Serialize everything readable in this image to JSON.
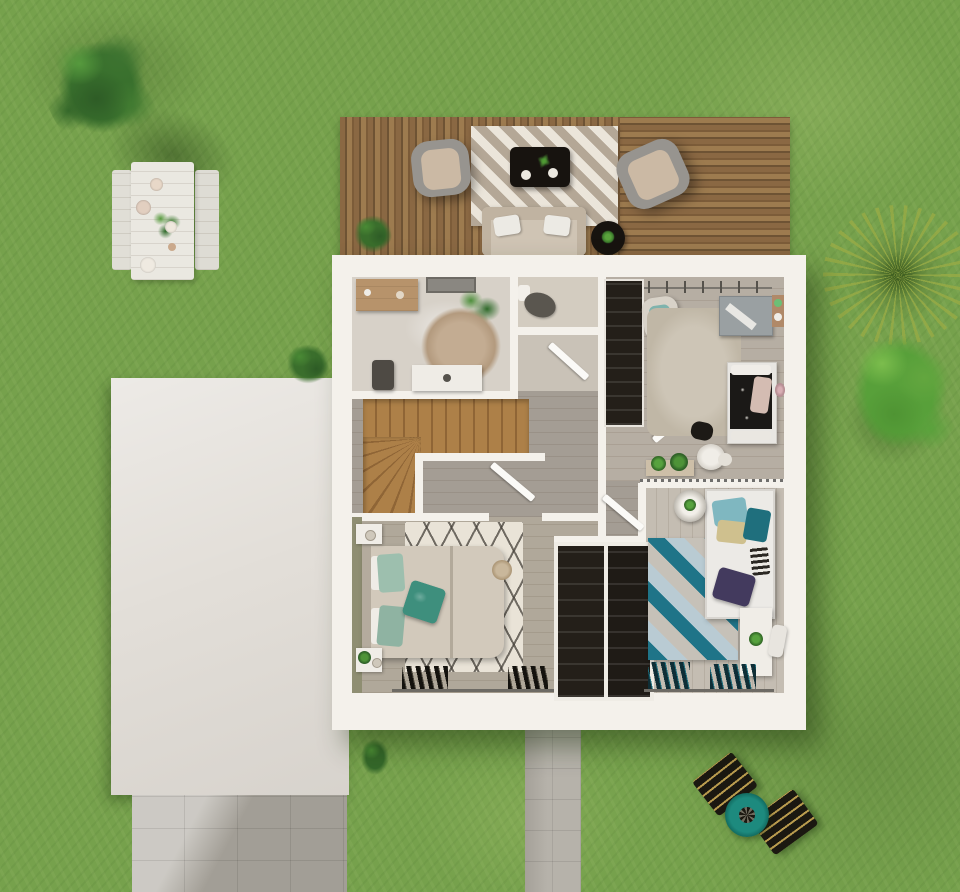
{
  "meta": {
    "content_type": "3d-architectural-floor-plan-render",
    "view": "top-down",
    "setting": "house upper floor on a grass lawn with wooden terrace and garden furniture"
  },
  "palette": {
    "grass": "#76a14c",
    "grassDark": "#5d8a3b",
    "grassLight": "#8cb258",
    "deck": "#8a6843",
    "deckDark": "#6e5334",
    "deckLight": "#9d7b4f",
    "wall": "#f4f1eb",
    "roof": "#e3dfd9",
    "floorLight": "#d7d1c8",
    "floorWc": "#d3ccc0",
    "floorHall": "#a49d94",
    "floorMaster": "#b0a89a",
    "floorKid": "#c4bdb2",
    "stair": "#ad8048",
    "stairDark": "#8f6536",
    "wardrobe": "#241f19",
    "rugRound": "#c3ac92",
    "rugShag": "#cdc5b6",
    "rugZigzagBase": "#e9e3d7",
    "bedDuvet": "#d2c9bb",
    "pillowTeal": "#9dbfae",
    "pillowAccent": "#3e8f7d",
    "tealDeep": "#1f7488",
    "blueLight": "#b9cbd3",
    "purplePillow": "#433a5e",
    "blackFurniture": "#17130f",
    "pathGray": "#b6b2aa",
    "loungerBlack": "#1b1811",
    "loungerStripe": "#b99b4e",
    "parasolTeal": "#1d8a7e",
    "plantDark": "#2f6a2a",
    "plantLight": "#579a3e",
    "woodFurniture": "#b7936b"
  },
  "garden": {
    "items": [
      {
        "name": "tree-top-left",
        "kind": "tree"
      },
      {
        "name": "picnic-table-set",
        "kind": "white table with two benches, plates and plant"
      },
      {
        "name": "wooden-terrace",
        "kind": "deck with two armchairs, chevron rug, black coffee table, sofa, side table, shrub"
      },
      {
        "name": "shrub-house-corner",
        "kind": "bush"
      },
      {
        "name": "shrub-near-path",
        "kind": "bush"
      },
      {
        "name": "palm-plant-right",
        "kind": "spiky palm"
      },
      {
        "name": "tree-right",
        "kind": "bright green tree"
      },
      {
        "name": "sun-loungers",
        "kind": "two black striped loungers with round teal table"
      },
      {
        "name": "driveway",
        "kind": "concrete tiled driveway"
      },
      {
        "name": "garden-path",
        "kind": "concrete tiled path"
      }
    ]
  },
  "house": {
    "rooms": [
      {
        "name": "bathroom",
        "furniture": [
          "wood-sideboard",
          "wall-mirror",
          "potted-plant",
          "round-jute-rug",
          "vanity-with-sink",
          "stool"
        ]
      },
      {
        "name": "wc",
        "furniture": [
          "toilet"
        ]
      },
      {
        "name": "bedroom-1-with-dressing",
        "furniture": [
          "dark-wardrobe",
          "clothes-rail",
          "armchair",
          "shag-rug",
          "desk",
          "wall-shelf",
          "black-bed",
          "pouf",
          "plant-console",
          "sheep-pouf"
        ]
      },
      {
        "name": "landing",
        "furniture": [
          "l-shaped-wooden-staircase",
          "open-doors"
        ]
      },
      {
        "name": "master-bedroom",
        "furniture": [
          "double-bed",
          "teal-pillows",
          "zigzag-berber-rug",
          "two-nightstands",
          "jute-pouf",
          "window-shutters"
        ]
      },
      {
        "name": "wardrobe-closets",
        "furniture": [
          "two-dark-built-in-closets"
        ]
      },
      {
        "name": "bedroom-2",
        "furniture": [
          "single-bed",
          "cube-pattern-rug",
          "round-side-table",
          "desk",
          "chair",
          "window-shutters"
        ]
      }
    ],
    "annex": {
      "name": "garage-flat-roof"
    }
  }
}
